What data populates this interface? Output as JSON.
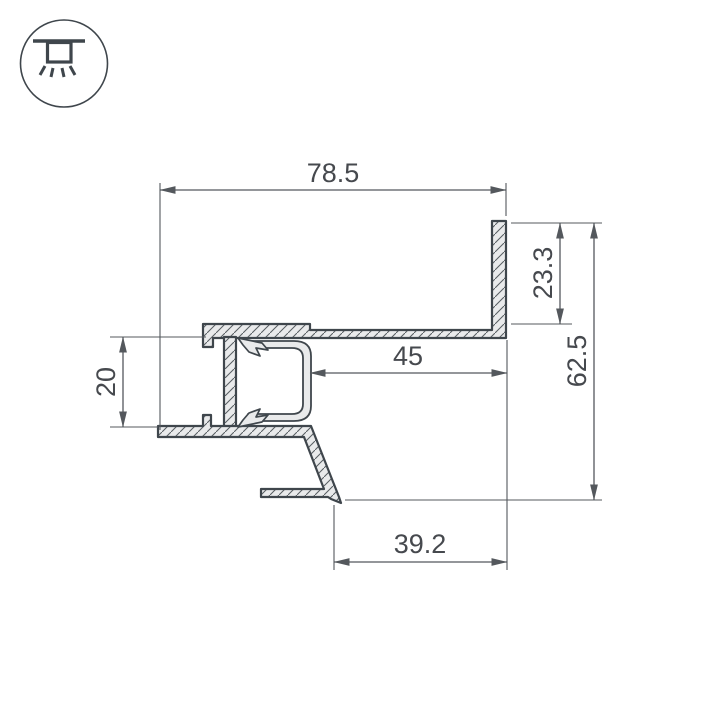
{
  "meta": {
    "type": "technical-drawing",
    "description": "Cross-section of recessed LED profile with dimensions"
  },
  "icon": {
    "name": "recessed-ceiling-light-icon"
  },
  "colors": {
    "background": "#ffffff",
    "outline": "#3f464c",
    "fill": "#e9eaeb",
    "dimension": "#54585d",
    "text": "#46494e",
    "hatch": "#565c61"
  },
  "drawing": {
    "units": "mm",
    "dims": {
      "overall_width": "78.5",
      "flange_height": "23.3",
      "overall_height": "62.5",
      "opening_width": "45",
      "mount_gap": "20",
      "bottom_width": "39.2"
    }
  }
}
